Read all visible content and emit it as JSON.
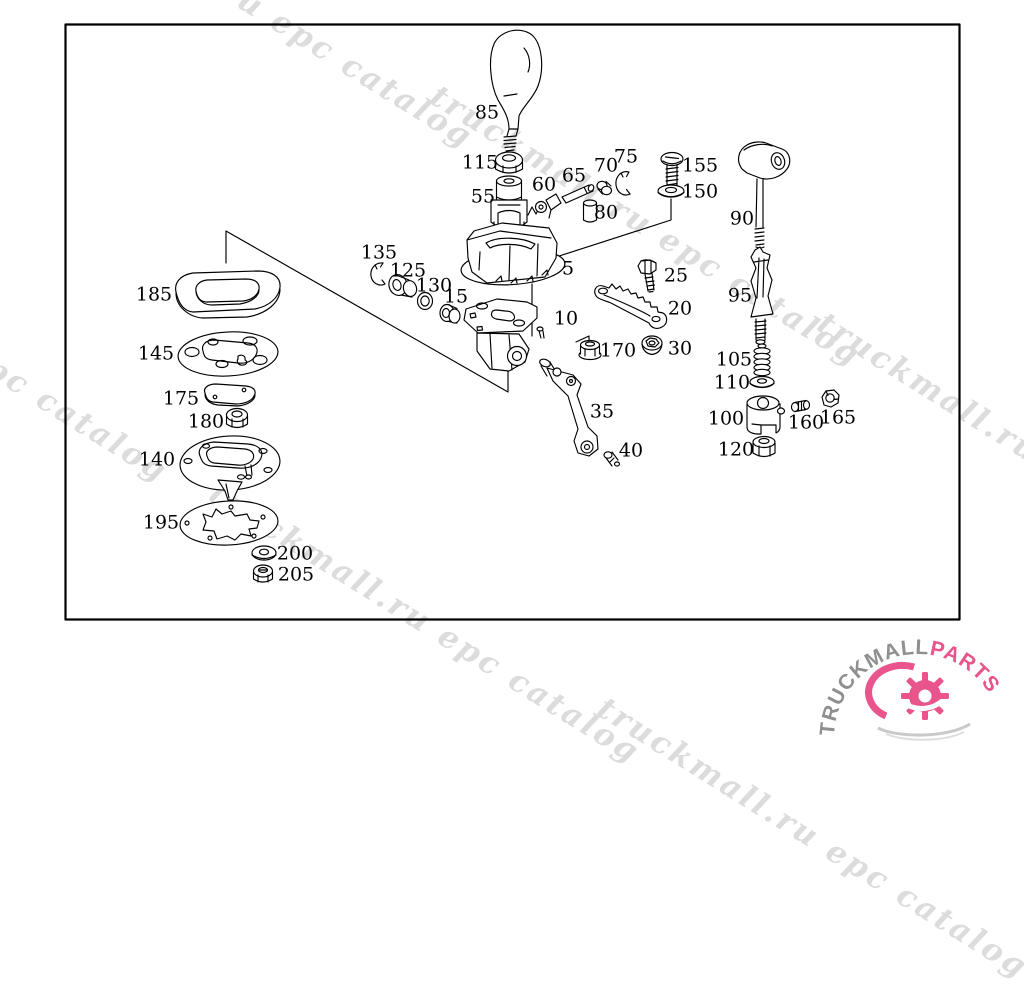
{
  "diagram": {
    "border_color": "#000000",
    "line_color": "#000000",
    "part_labels": [
      {
        "text": "85",
        "x": 487,
        "y": 113
      },
      {
        "text": "115",
        "x": 480,
        "y": 163
      },
      {
        "text": "55",
        "x": 483,
        "y": 197
      },
      {
        "text": "60",
        "x": 544,
        "y": 185
      },
      {
        "text": "65",
        "x": 574,
        "y": 176
      },
      {
        "text": "70",
        "x": 606,
        "y": 166
      },
      {
        "text": "75",
        "x": 626,
        "y": 157
      },
      {
        "text": "80",
        "x": 606,
        "y": 213
      },
      {
        "text": "155",
        "x": 700,
        "y": 166
      },
      {
        "text": "150",
        "x": 700,
        "y": 192
      },
      {
        "text": "90",
        "x": 742,
        "y": 219
      },
      {
        "text": "95",
        "x": 740,
        "y": 296
      },
      {
        "text": "135",
        "x": 379,
        "y": 253
      },
      {
        "text": "125",
        "x": 408,
        "y": 271
      },
      {
        "text": "130",
        "x": 434,
        "y": 286
      },
      {
        "text": "15",
        "x": 456,
        "y": 297
      },
      {
        "text": "5",
        "x": 568,
        "y": 269
      },
      {
        "text": "10",
        "x": 566,
        "y": 319
      },
      {
        "text": "25",
        "x": 676,
        "y": 276
      },
      {
        "text": "20",
        "x": 680,
        "y": 309
      },
      {
        "text": "170",
        "x": 618,
        "y": 351
      },
      {
        "text": "30",
        "x": 680,
        "y": 349
      },
      {
        "text": "105",
        "x": 734,
        "y": 360
      },
      {
        "text": "110",
        "x": 732,
        "y": 383
      },
      {
        "text": "100",
        "x": 726,
        "y": 419
      },
      {
        "text": "120",
        "x": 736,
        "y": 450
      },
      {
        "text": "160",
        "x": 806,
        "y": 423
      },
      {
        "text": "165",
        "x": 838,
        "y": 418
      },
      {
        "text": "35",
        "x": 602,
        "y": 412
      },
      {
        "text": "40",
        "x": 631,
        "y": 451
      },
      {
        "text": "185",
        "x": 154,
        "y": 295
      },
      {
        "text": "145",
        "x": 156,
        "y": 354
      },
      {
        "text": "175",
        "x": 181,
        "y": 399
      },
      {
        "text": "180",
        "x": 206,
        "y": 422
      },
      {
        "text": "140",
        "x": 157,
        "y": 460
      },
      {
        "text": "195",
        "x": 161,
        "y": 523
      },
      {
        "text": "200",
        "x": 295,
        "y": 554
      },
      {
        "text": "205",
        "x": 296,
        "y": 575
      }
    ]
  },
  "watermark": {
    "text": "truckmall.ru epc catalog",
    "color": "#dcdcdc",
    "instances": [
      {
        "x": 55,
        "y": -140
      },
      {
        "x": 443,
        "y": 78
      },
      {
        "x": -250,
        "y": 194
      },
      {
        "x": 222,
        "y": 475
      },
      {
        "x": 830,
        "y": 305
      },
      {
        "x": 610,
        "y": 690
      }
    ]
  },
  "logo": {
    "brand_primary": "TRUCKMALL",
    "brand_secondary": "PARTS",
    "primary_color": "#8f8f8f",
    "secondary_color": "#e8548b"
  }
}
